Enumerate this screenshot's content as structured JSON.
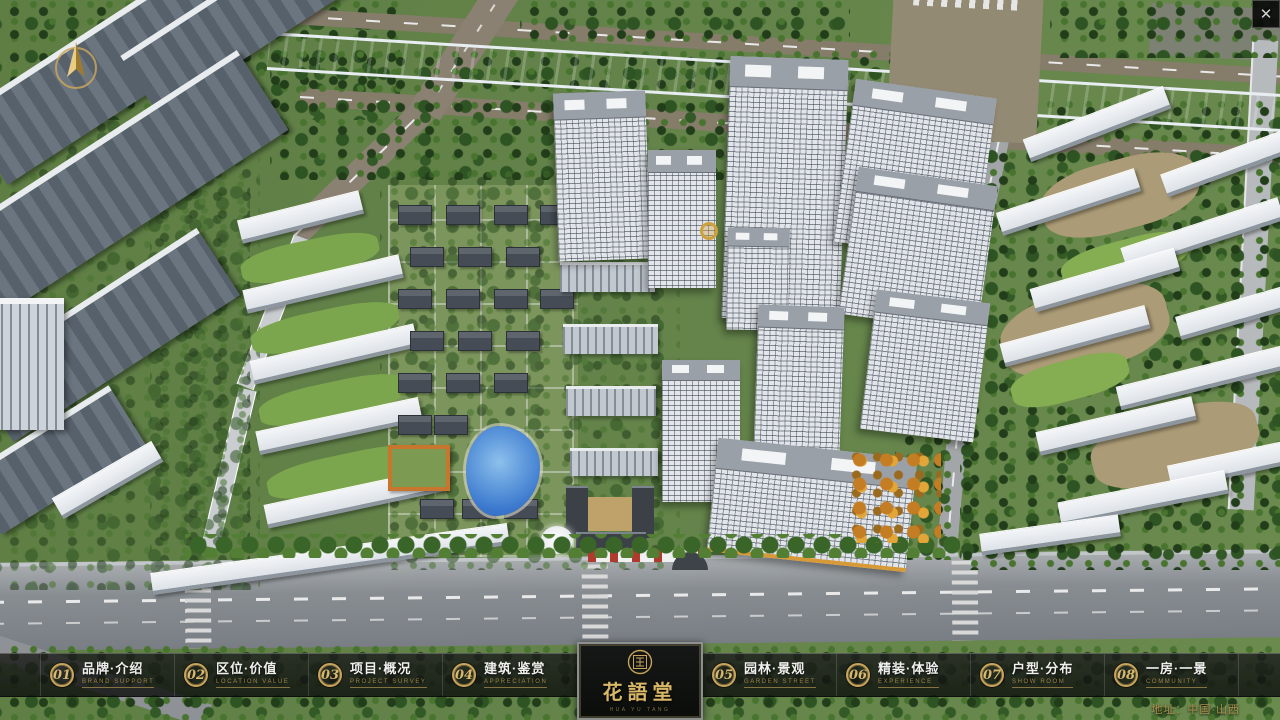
{
  "window": {
    "close_label": "✕",
    "close_icon": "close-x-icon",
    "compass_icon": "north-compass-arrow-icon"
  },
  "logo": {
    "seal_icon": "hua-yu-tang-seal-icon",
    "name": "花語堂",
    "caption": "HUA YU TANG"
  },
  "footer": {
    "items_left": [
      {
        "num": "01",
        "zh": "品牌·介绍",
        "en": "BRAND SUPPORT"
      },
      {
        "num": "02",
        "zh": "区位·价值",
        "en": "LOCATION VALUE"
      },
      {
        "num": "03",
        "zh": "项目·概况",
        "en": "PROJECT SURVEY"
      },
      {
        "num": "04",
        "zh": "建筑·鉴赏",
        "en": "APPRECIATION"
      }
    ],
    "items_right": [
      {
        "num": "05",
        "zh": "园林·景观",
        "en": "GARDEN STREET"
      },
      {
        "num": "06",
        "zh": "精装·体验",
        "en": "EXPERIENCE"
      },
      {
        "num": "07",
        "zh": "户型·分布",
        "en": "SHOW ROOM"
      },
      {
        "num": "08",
        "zh": "一房·一景",
        "en": "COMMUNITY"
      }
    ],
    "address": "地址：中国·山西"
  },
  "colors": {
    "gold": "#c9a45c",
    "bar_background": "rgba(16,18,16,0.83)",
    "canal_blue": "#2e5cc0",
    "facade_white": "#e2e5ea",
    "tree_green": "#2f5423"
  }
}
